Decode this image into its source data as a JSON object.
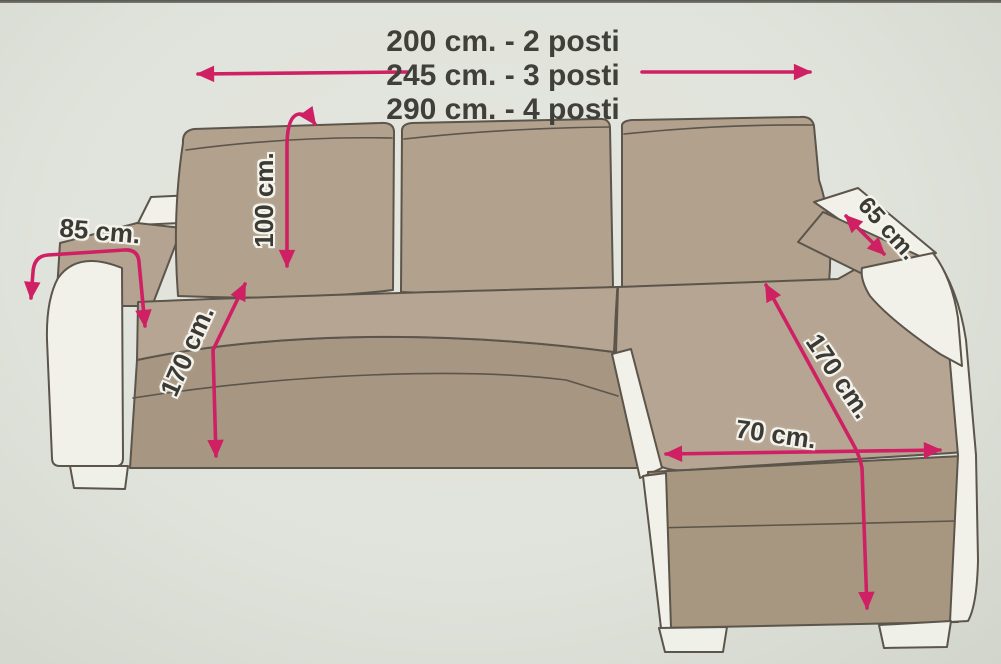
{
  "title_block": {
    "lines": [
      "200 cm. - 2 posti",
      "245 cm. - 3 posti",
      "290 cm. - 4 posti"
    ]
  },
  "dimensions": {
    "armrest_width": "85 cm.",
    "backrest_height": "100 cm.",
    "sofa_depth": "170 cm.",
    "armrest_length": "65 cm.",
    "chaise_length": "170 cm.",
    "chaise_width": "70 cm."
  },
  "palette": {
    "arrow_pink": "#cf2063",
    "cover_tan": "#b4a390",
    "cover_tan_dark": "#a79681",
    "sofa_white": "#f2f1e9",
    "outline": "#5b554b",
    "text": "#3c3a34",
    "background": "#e0e3db"
  }
}
